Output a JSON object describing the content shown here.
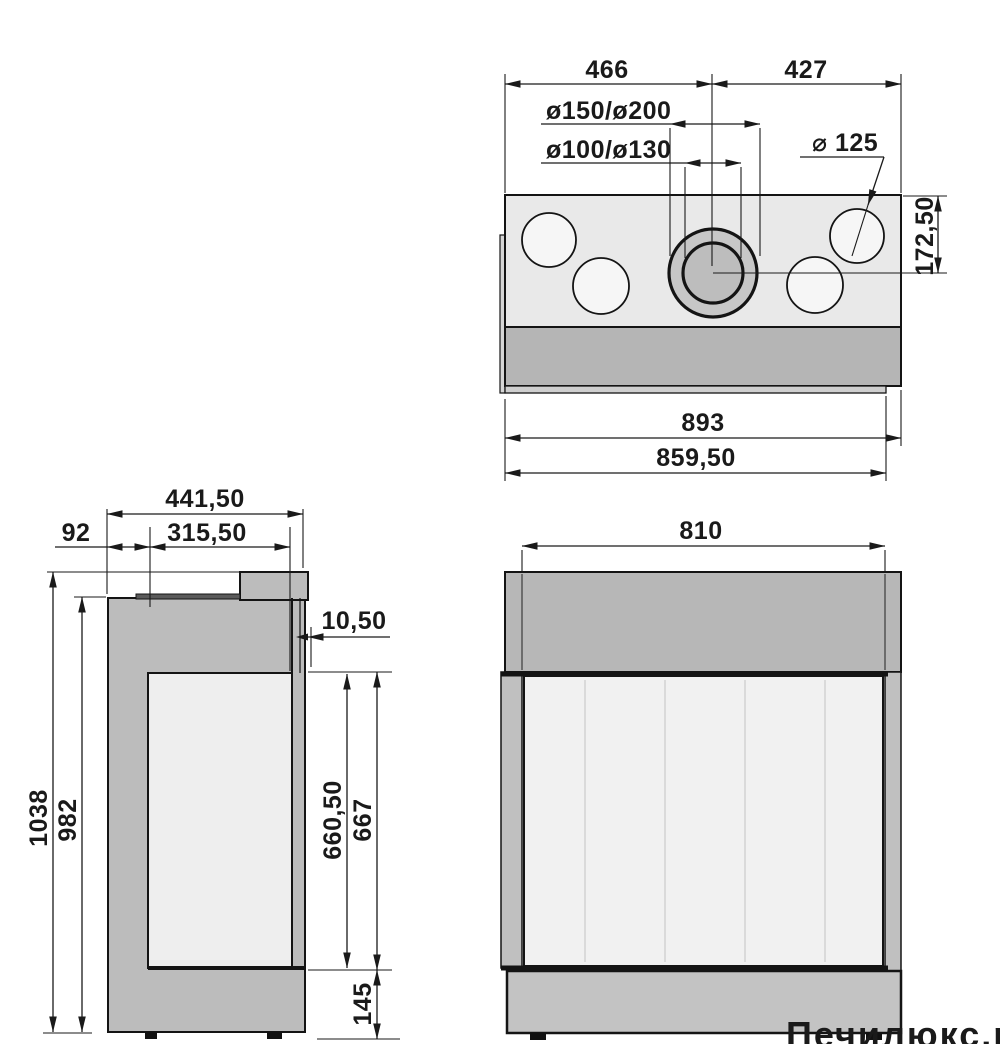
{
  "drawing": {
    "kind": "fireplace-insert-dimension-drawing",
    "views": [
      "top-view",
      "side-view",
      "front-view"
    ],
    "line_color": "#1a1a1a",
    "fill_light_body": "#e9e9e9",
    "fill_hole_circle": "#f6f6f6",
    "fill_dark_band": "#b5b5b5",
    "fill_flue_outer": "#c7c7c7",
    "fill_flue_inner": "#bdbdbd",
    "fill_side_body": "#bcbcbc",
    "fill_front_band": "#b7b7b7",
    "fill_glass": "#f1f1f1",
    "fill_base": "#c3c3c3",
    "watermark_color": "#bdb6b0"
  },
  "dims": {
    "top_left": "466",
    "top_right": "427",
    "pipe_outer": "ø150/ø200",
    "pipe_inner": "ø100/ø130",
    "hole_dia": "⌀ 125",
    "flue_offset": "172,50",
    "width_overall": "893",
    "width_body": "859,50",
    "depth_overall": "441,50",
    "depth_back": "92",
    "depth_glass": "315,50",
    "front_lip": "10,50",
    "height_overall": "1038",
    "height_body": "982",
    "glass_height_inner": "660,50",
    "glass_height": "667",
    "base_height": "145",
    "front_width": "810"
  },
  "watermark": "Печилюкс.ру"
}
